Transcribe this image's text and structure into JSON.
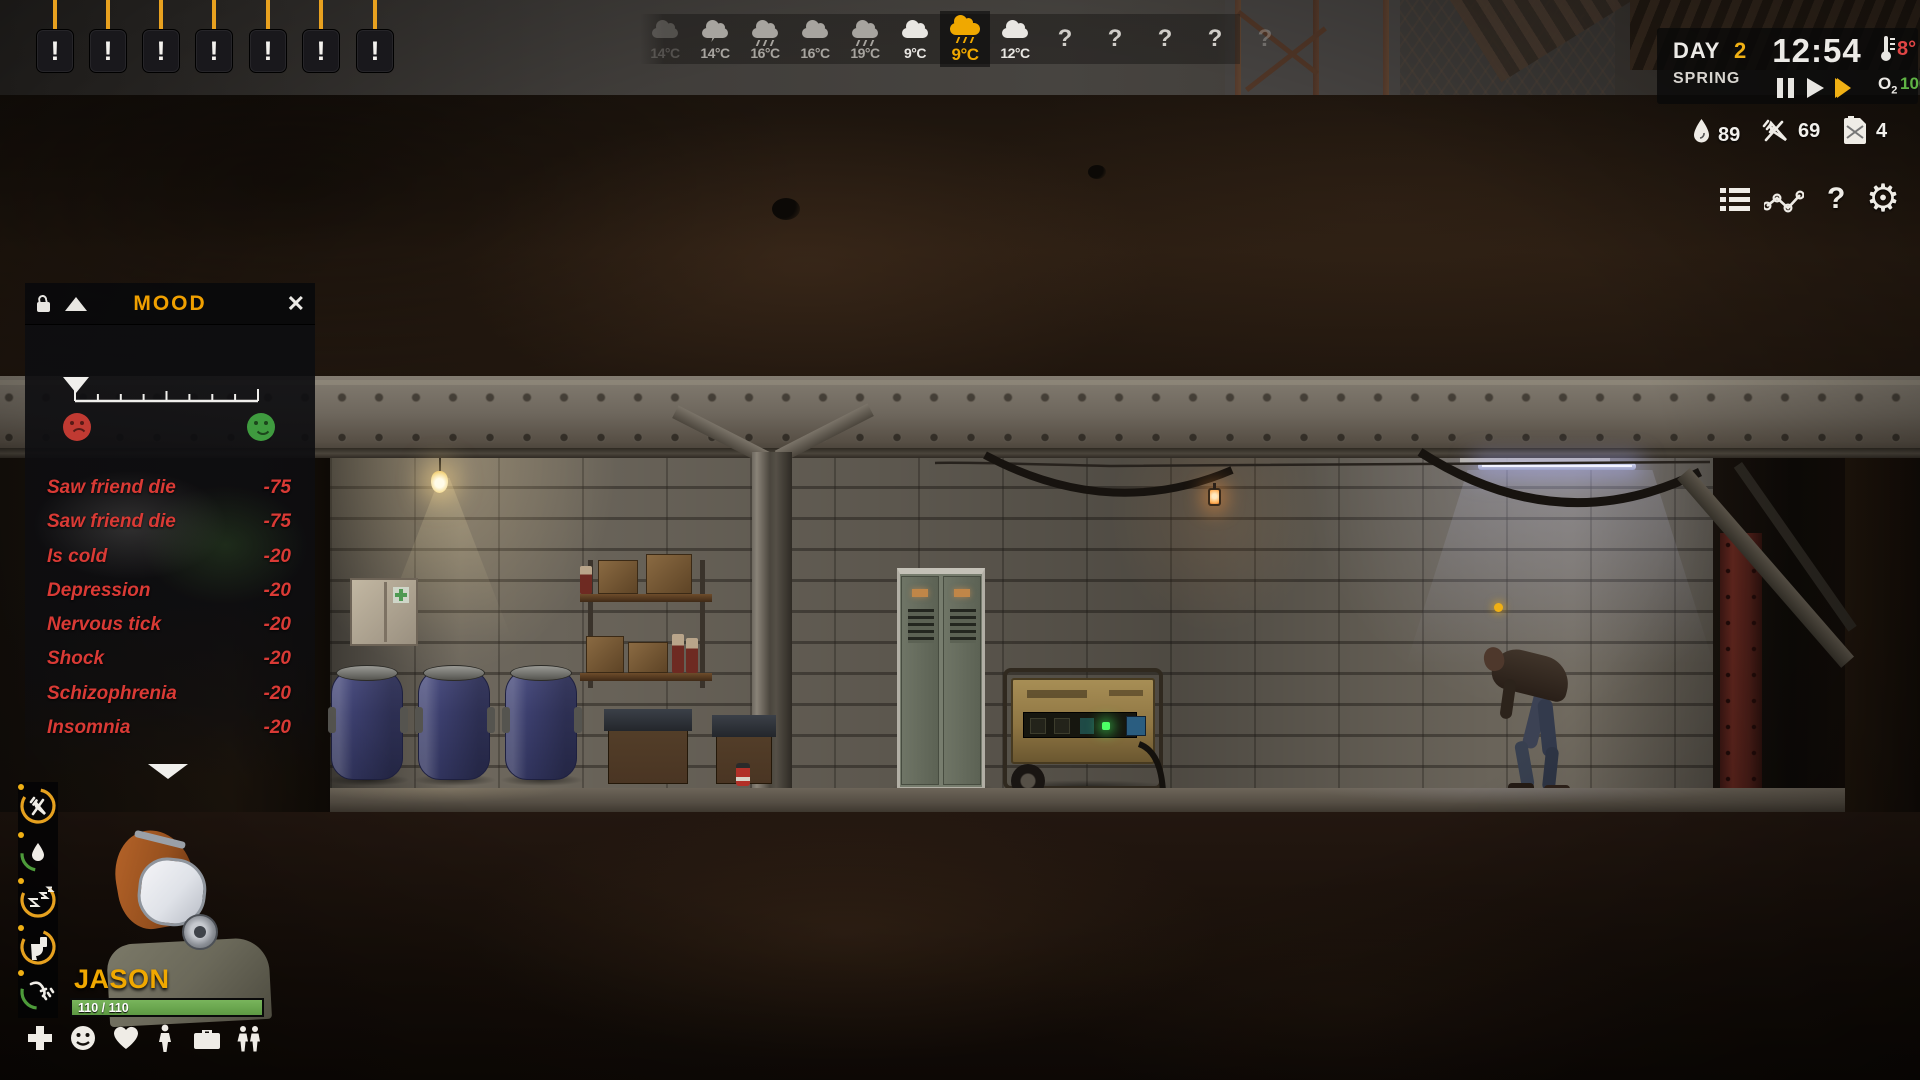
{
  "alerts": {
    "badges": [
      "!",
      "!",
      "!",
      "!",
      "!",
      "!",
      "!"
    ]
  },
  "weather": {
    "entries": [
      {
        "temp": "14°C",
        "icon": "cloud",
        "state": "faded"
      },
      {
        "temp": "14°C",
        "icon": "storm",
        "state": "dim"
      },
      {
        "temp": "16°C",
        "icon": "rain",
        "state": "dim"
      },
      {
        "temp": "16°C",
        "icon": "cloud",
        "state": "dim"
      },
      {
        "temp": "19°C",
        "icon": "rain",
        "state": "dim"
      },
      {
        "temp": "9°C",
        "icon": "cloud",
        "state": "bright"
      },
      {
        "temp": "9°C",
        "icon": "rain",
        "state": "selected"
      },
      {
        "temp": "12°C",
        "icon": "cloud",
        "state": "bright"
      },
      {
        "temp": "?",
        "icon": "unknown",
        "state": "normal"
      },
      {
        "temp": "?",
        "icon": "unknown",
        "state": "normal"
      },
      {
        "temp": "?",
        "icon": "unknown",
        "state": "normal"
      },
      {
        "temp": "?",
        "icon": "unknown",
        "state": "normal"
      },
      {
        "temp": "?",
        "icon": "unknown",
        "state": "faded"
      }
    ]
  },
  "clock": {
    "day_label": "DAY",
    "day_value": "2",
    "season": "SPRING",
    "time": "12:54",
    "temperature": "8°",
    "o2_label": "O",
    "o2_sub": "2",
    "o2_value": "100%"
  },
  "resources": {
    "water": "89",
    "food": "69",
    "fuel": "4"
  },
  "menu": {
    "help_glyph": "?",
    "gear_glyph": "⚙"
  },
  "mood_panel": {
    "title": "MOOD",
    "close_glyph": "✕",
    "slider_value_pct": 3,
    "items": [
      {
        "label": "Saw friend die",
        "value": "-75"
      },
      {
        "label": "Saw friend die",
        "value": "-75"
      },
      {
        "label": "Is cold",
        "value": "-20"
      },
      {
        "label": "Depression",
        "value": "-20"
      },
      {
        "label": "Nervous tick",
        "value": "-20"
      },
      {
        "label": "Shock",
        "value": "-20"
      },
      {
        "label": "Schizophrenia",
        "value": "-20"
      },
      {
        "label": "Insomnia",
        "value": "-20"
      }
    ]
  },
  "character": {
    "name": "JASON",
    "health": "110 / 110"
  },
  "needs": [
    {
      "name": "food",
      "pct": 82,
      "color": "#e6a11f"
    },
    {
      "name": "water",
      "pct": 23,
      "color": "#4d9b3a"
    },
    {
      "name": "sleep",
      "pct": 70,
      "color": "#e6a11f"
    },
    {
      "name": "toilet",
      "pct": 78,
      "color": "#e6a11f"
    },
    {
      "name": "hygiene",
      "pct": 27,
      "color": "#4d9b3a"
    }
  ],
  "colors": {
    "accent_yellow": "#f0a800",
    "alert_line": "#e8a11f",
    "mood_negative_text": "#d93a35",
    "health_green": "#6aa84f",
    "o2_green": "#5fb345",
    "temp_red": "#e04545"
  }
}
